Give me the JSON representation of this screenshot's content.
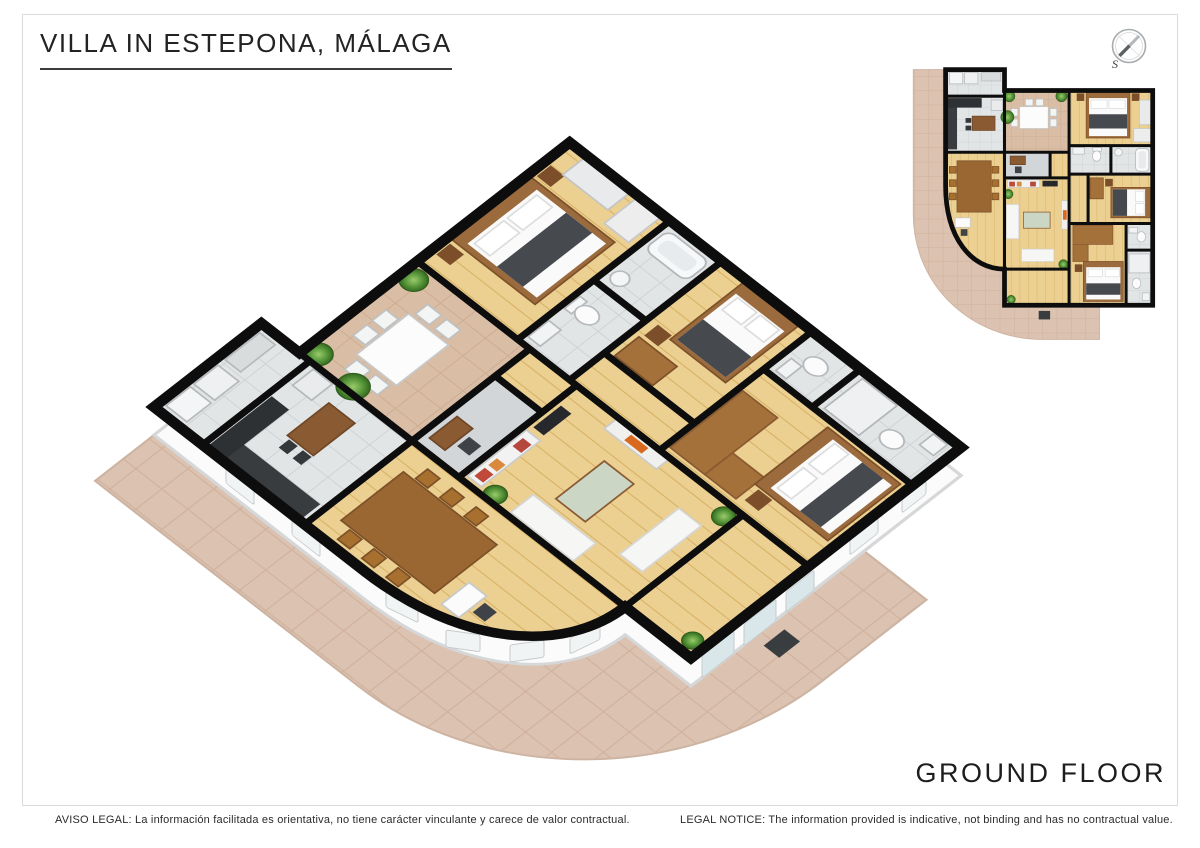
{
  "header": {
    "title": "VILLA IN ESTEPONA, MÁLAGA"
  },
  "floor_label": "GROUND FLOOR",
  "compass": {
    "south_label": "S"
  },
  "footer": {
    "legal_es": "AVISO LEGAL: La información facilitada es orientativa, no tiene carácter vinculante y carece de valor contractual.",
    "legal_en": "LEGAL NOTICE: The information provided is indicative, not binding and has no contractual value."
  },
  "colors": {
    "wall": "#0d0d0d",
    "wood_floor": "#ebd092",
    "wood_line": "#d8b164",
    "tile_floor": "#e2e5e6",
    "patio_floor": "#d9bda5",
    "terrace": "#dcc2b0",
    "hall_floor": "#d3d6d8",
    "wall_face": "#fbfbfb",
    "glass": "#d9e6ea",
    "window": "#f1f4f5",
    "wood_furniture": "#9c6b3d",
    "dark_furniture": "#393c3f",
    "frame_border": "#d9dadb",
    "text": "#232323"
  },
  "plan": {
    "outline": "M48,8 H110 V30 H266 V256 H110 V218 C75,218 48,185 48,130 Z",
    "terrace": "M48,8 V130 C48,185 75,218 110,218 V256 H210 V292 H150 C75,292 14,235 14,160 V8 Z",
    "walls": [
      "M48,36 H110",
      "M48,95 H110",
      "M110,8 V218",
      "M110,95 H178",
      "M110,122 H178",
      "M158,95 V122",
      "M178,30 V256",
      "M178,88 H266",
      "M222,88 V118",
      "M178,118 H266",
      "M198,118 V170",
      "M178,170 H266",
      "M238,170 V256",
      "M238,198 H266",
      "M110,218 H178"
    ],
    "rooms": [
      {
        "name": "utility-room",
        "floor": "tile",
        "rect": [
          48,
          8,
          62,
          28
        ]
      },
      {
        "name": "kitchen",
        "floor": "tile",
        "rect": [
          48,
          36,
          62,
          59
        ]
      },
      {
        "name": "dining-room",
        "floor": "wood",
        "path": "M48,95 H110 V218 C75,218 48,185 48,130 Z"
      },
      {
        "name": "patio-terrace",
        "floor": "tan",
        "rect": [
          110,
          30,
          68,
          65
        ]
      },
      {
        "name": "bedroom-1",
        "floor": "wood",
        "rect": [
          178,
          30,
          88,
          58
        ]
      },
      {
        "name": "entry-hall",
        "floor": "gray",
        "rect": [
          110,
          95,
          48,
          27
        ]
      },
      {
        "name": "corridor-to-patio",
        "floor": "wood",
        "rect": [
          158,
          95,
          20,
          27
        ]
      },
      {
        "name": "living-room",
        "floor": "wood",
        "rect": [
          110,
          122,
          68,
          96
        ]
      },
      {
        "name": "bathroom-1",
        "floor": "tile",
        "rect": [
          178,
          88,
          44,
          30
        ]
      },
      {
        "name": "bathroom-2",
        "floor": "tile",
        "rect": [
          222,
          88,
          44,
          30
        ]
      },
      {
        "name": "corridor",
        "floor": "wood",
        "rect": [
          178,
          118,
          20,
          52
        ]
      },
      {
        "name": "bedroom-2",
        "floor": "wood",
        "rect": [
          198,
          118,
          68,
          52
        ]
      },
      {
        "name": "wc",
        "floor": "tile",
        "rect": [
          238,
          170,
          28,
          28
        ]
      },
      {
        "name": "bedroom-3",
        "floor": "wood",
        "rect": [
          178,
          170,
          60,
          86
        ]
      },
      {
        "name": "bathroom-3",
        "floor": "tile",
        "rect": [
          238,
          198,
          28,
          58
        ]
      },
      {
        "name": "sunroom",
        "floor": "wood",
        "rect": [
          110,
          218,
          68,
          38
        ]
      }
    ],
    "furniture": [
      {
        "k": "r",
        "x": 52,
        "y": 11,
        "w": 14,
        "h": 12,
        "f": "#f4f5f6",
        "s": "#b7babc"
      },
      {
        "k": "r",
        "x": 68,
        "y": 11,
        "w": 14,
        "h": 12,
        "f": "#eef0f1",
        "s": "#b7babc"
      },
      {
        "k": "r",
        "x": 86,
        "y": 11,
        "w": 20,
        "h": 9,
        "f": "#d9dcdd",
        "s": "#b7babc"
      },
      {
        "k": "r",
        "x": 50,
        "y": 40,
        "w": 10,
        "h": 52,
        "f": "#393c3f"
      },
      {
        "k": "r",
        "x": 50,
        "y": 38,
        "w": 36,
        "h": 10,
        "f": "#2e3134"
      },
      {
        "k": "r",
        "x": 96,
        "y": 40,
        "w": 12,
        "h": 11,
        "f": "#e9ebec",
        "s": "#b7babc"
      },
      {
        "k": "r",
        "x": 76,
        "y": 57,
        "w": 24,
        "h": 15,
        "f": "#8a5a33",
        "s": "#6f4726"
      },
      {
        "k": "r",
        "x": 69,
        "y": 59,
        "w": 6,
        "h": 5,
        "f": "#35383b"
      },
      {
        "k": "r",
        "x": 69,
        "y": 67,
        "w": 6,
        "h": 5,
        "f": "#35383b"
      },
      {
        "k": "r",
        "x": 126,
        "y": 47,
        "w": 30,
        "h": 23,
        "f": "#fcfcfc",
        "s": "#c7c9ca"
      },
      {
        "k": "r",
        "x": 117,
        "y": 49,
        "w": 7,
        "h": 8,
        "f": "#f3f4f4",
        "s": "#bfc1c2"
      },
      {
        "k": "r",
        "x": 117,
        "y": 60,
        "w": 7,
        "h": 8,
        "f": "#f3f4f4",
        "s": "#bfc1c2"
      },
      {
        "k": "r",
        "x": 158,
        "y": 49,
        "w": 7,
        "h": 8,
        "f": "#f3f4f4",
        "s": "#bfc1c2"
      },
      {
        "k": "r",
        "x": 158,
        "y": 60,
        "w": 7,
        "h": 8,
        "f": "#f3f4f4",
        "s": "#bfc1c2"
      },
      {
        "k": "r",
        "x": 132,
        "y": 39,
        "w": 8,
        "h": 7,
        "f": "#f3f4f4",
        "s": "#bfc1c2"
      },
      {
        "k": "r",
        "x": 143,
        "y": 39,
        "w": 8,
        "h": 7,
        "f": "#f3f4f4",
        "s": "#bfc1c2"
      },
      {
        "k": "p",
        "cx": 115,
        "cy": 36,
        "r": 6
      },
      {
        "k": "p",
        "cx": 170,
        "cy": 36,
        "r": 6
      },
      {
        "k": "p",
        "cx": 113,
        "cy": 58,
        "r": 7
      },
      {
        "k": "r",
        "x": 186,
        "y": 33,
        "w": 8,
        "h": 8,
        "f": "#7c4f2a"
      },
      {
        "k": "r",
        "x": 244,
        "y": 33,
        "w": 8,
        "h": 8,
        "f": "#7c4f2a"
      },
      {
        "k": "r",
        "x": 196,
        "y": 32,
        "w": 46,
        "h": 48,
        "f": "#9c6b3d",
        "s": "#7d5128"
      },
      {
        "k": "r",
        "x": 199,
        "y": 38,
        "w": 40,
        "h": 40,
        "f": "#fafafa"
      },
      {
        "k": "r",
        "x": 201,
        "y": 40,
        "w": 17,
        "h": 9,
        "f": "#ffffff",
        "s": "#dddddd"
      },
      {
        "k": "r",
        "x": 220,
        "y": 40,
        "w": 17,
        "h": 9,
        "f": "#ffffff",
        "s": "#dddddd"
      },
      {
        "k": "r",
        "x": 199,
        "y": 55,
        "w": 40,
        "h": 15,
        "f": "#46494e"
      },
      {
        "k": "r",
        "x": 252,
        "y": 40,
        "w": 12,
        "h": 26,
        "f": "#e9eaeb",
        "s": "#c2c4c6"
      },
      {
        "k": "r",
        "x": 246,
        "y": 70,
        "w": 18,
        "h": 14,
        "f": "#ededee",
        "s": "#c6c8ca"
      },
      {
        "k": "r",
        "x": 116,
        "y": 99,
        "w": 16,
        "h": 9,
        "f": "#8a5a33",
        "s": "#6f4726"
      },
      {
        "k": "r",
        "x": 121,
        "y": 110,
        "w": 7,
        "h": 7,
        "f": "#3f4347"
      },
      {
        "k": "r",
        "x": 182,
        "y": 90,
        "w": 12,
        "h": 7,
        "f": "#f2f3f4",
        "s": "#b7babc"
      },
      {
        "k": "r",
        "x": 203,
        "y": 90,
        "w": 9,
        "h": 4,
        "f": "#f6f7f8",
        "s": "#b7babc"
      },
      {
        "k": "e",
        "cx": 207,
        "cy": 99,
        "rx": 4.5,
        "ry": 5.5,
        "f": "#fbfbfc",
        "s": "#b7babc"
      },
      {
        "k": "e",
        "cx": 230,
        "cy": 95,
        "rx": 4,
        "ry": 4,
        "f": "#f4f5f6",
        "s": "#b7babc"
      },
      {
        "k": "r",
        "x": 248,
        "y": 91,
        "w": 14,
        "h": 24,
        "rx": 4,
        "f": "#f7f8f9",
        "s": "#b2b6b8"
      },
      {
        "k": "r",
        "x": 251,
        "y": 94,
        "w": 8,
        "h": 18,
        "rx": 3,
        "f": "#e7ebed"
      },
      {
        "k": "r",
        "x": 60,
        "y": 104,
        "w": 36,
        "h": 54,
        "f": "#9a6733",
        "s": "#7d5128"
      },
      {
        "k": "r",
        "x": 52,
        "y": 110,
        "w": 7,
        "h": 7,
        "f": "#a8702f",
        "s": "#7d5128"
      },
      {
        "k": "r",
        "x": 52,
        "y": 124,
        "w": 7,
        "h": 7,
        "f": "#a8702f",
        "s": "#7d5128"
      },
      {
        "k": "r",
        "x": 52,
        "y": 138,
        "w": 7,
        "h": 7,
        "f": "#a8702f",
        "s": "#7d5128"
      },
      {
        "k": "r",
        "x": 97,
        "y": 110,
        "w": 7,
        "h": 7,
        "f": "#a8702f",
        "s": "#7d5128"
      },
      {
        "k": "r",
        "x": 97,
        "y": 124,
        "w": 7,
        "h": 7,
        "f": "#a8702f",
        "s": "#7d5128"
      },
      {
        "k": "r",
        "x": 97,
        "y": 138,
        "w": 7,
        "h": 7,
        "f": "#a8702f",
        "s": "#7d5128"
      },
      {
        "k": "r",
        "x": 58,
        "y": 164,
        "w": 16,
        "h": 10,
        "f": "#fbfbfc",
        "s": "#c7c9ca"
      },
      {
        "k": "r",
        "x": 64,
        "y": 176,
        "w": 7,
        "h": 7,
        "f": "#3f4347"
      },
      {
        "k": "r",
        "x": 113,
        "y": 124,
        "w": 34,
        "h": 8,
        "f": "#f2f2f3",
        "s": "#c9cbcc"
      },
      {
        "k": "r",
        "x": 115,
        "y": 126,
        "w": 6,
        "h": 5,
        "f": "#c04a3a"
      },
      {
        "k": "r",
        "x": 123,
        "y": 126,
        "w": 5,
        "h": 5,
        "f": "#d98a3d"
      },
      {
        "k": "r",
        "x": 137,
        "y": 126,
        "w": 6,
        "h": 5,
        "f": "#b5483b"
      },
      {
        "k": "r",
        "x": 150,
        "y": 125,
        "w": 16,
        "h": 6,
        "f": "#26282b"
      },
      {
        "k": "r",
        "x": 112,
        "y": 150,
        "w": 13,
        "h": 36,
        "f": "#f6f6f5",
        "s": "#d6d6d4"
      },
      {
        "k": "r",
        "x": 128,
        "y": 197,
        "w": 34,
        "h": 13,
        "f": "#f6f6f5",
        "s": "#d6d6d4"
      },
      {
        "k": "r",
        "x": 130,
        "y": 158,
        "w": 28,
        "h": 17,
        "f": "#ccd6c5",
        "s": "#8a5a33"
      },
      {
        "k": "r",
        "x": 170,
        "y": 146,
        "w": 7,
        "h": 30,
        "f": "#f0f0ef",
        "s": "#cccccc"
      },
      {
        "k": "r",
        "x": 171.5,
        "y": 156,
        "w": 4,
        "h": 10,
        "f": "#d8691f"
      },
      {
        "k": "p",
        "cx": 114,
        "cy": 139,
        "r": 5
      },
      {
        "k": "p",
        "cx": 172,
        "cy": 213,
        "r": 5
      },
      {
        "k": "r",
        "x": 200,
        "y": 122,
        "w": 14,
        "h": 22,
        "f": "#a4713b",
        "s": "#7d5128"
      },
      {
        "k": "r",
        "x": 216,
        "y": 123,
        "w": 8,
        "h": 8,
        "f": "#7c4f2a"
      },
      {
        "k": "r",
        "x": 222,
        "y": 132,
        "w": 42,
        "h": 32,
        "f": "#9c6b3d",
        "s": "#7d5128"
      },
      {
        "k": "r",
        "x": 224,
        "y": 134,
        "w": 34,
        "h": 28,
        "f": "#fafafa"
      },
      {
        "k": "r",
        "x": 248,
        "y": 136,
        "w": 9,
        "h": 11,
        "f": "#ffffff",
        "s": "#dddddd"
      },
      {
        "k": "r",
        "x": 248,
        "y": 149,
        "w": 9,
        "h": 11,
        "f": "#ffffff",
        "s": "#dddddd"
      },
      {
        "k": "r",
        "x": 224,
        "y": 134,
        "w": 15,
        "h": 28,
        "f": "#46494e"
      },
      {
        "k": "r",
        "x": 241,
        "y": 174,
        "w": 9,
        "h": 6,
        "f": "#f2f3f4",
        "s": "#b7babc"
      },
      {
        "k": "e",
        "cx": 254,
        "cy": 184,
        "rx": 4.5,
        "ry": 5.5,
        "f": "#fbfbfc",
        "s": "#b7babc"
      },
      {
        "k": "r",
        "x": 182,
        "y": 172,
        "w": 42,
        "h": 20,
        "f": "#a4713b",
        "s": "#8a5a30"
      },
      {
        "k": "r",
        "x": 182,
        "y": 192,
        "w": 16,
        "h": 18,
        "f": "#a4713b",
        "s": "#8a5a30"
      },
      {
        "k": "r",
        "x": 184,
        "y": 213,
        "w": 8,
        "h": 8,
        "f": "#7c4f2a"
      },
      {
        "k": "r",
        "x": 193,
        "y": 210,
        "w": 42,
        "h": 42,
        "f": "#9c6b3d",
        "s": "#7d5128"
      },
      {
        "k": "r",
        "x": 196,
        "y": 216,
        "w": 36,
        "h": 34,
        "f": "#fafafa"
      },
      {
        "k": "r",
        "x": 198,
        "y": 218,
        "w": 15,
        "h": 8,
        "f": "#ffffff",
        "s": "#dddddd"
      },
      {
        "k": "r",
        "x": 216,
        "y": 218,
        "w": 15,
        "h": 8,
        "f": "#ffffff",
        "s": "#dddddd"
      },
      {
        "k": "r",
        "x": 196,
        "y": 233,
        "w": 36,
        "h": 12,
        "f": "#46494e"
      },
      {
        "k": "r",
        "x": 241,
        "y": 202,
        "w": 22,
        "h": 20,
        "f": "#eef0f1",
        "s": "#b2b6b8"
      },
      {
        "k": "e",
        "cx": 249,
        "cy": 233,
        "rx": 4.5,
        "ry": 5.5,
        "f": "#fbfbfc",
        "s": "#b7babc"
      },
      {
        "k": "r",
        "x": 255,
        "y": 243,
        "w": 8,
        "h": 8,
        "f": "#f2f3f4",
        "s": "#b7babc"
      },
      {
        "k": "p",
        "cx": 117,
        "cy": 250,
        "r": 4.5
      }
    ],
    "terrace_furniture": [
      {
        "k": "r",
        "x": 146,
        "y": 262,
        "w": 12,
        "h": 9,
        "f": "#3a3d40"
      },
      {
        "k": "p",
        "cx": 122,
        "cy": 226,
        "r": 4
      }
    ],
    "skirt_windows": [
      {
        "x": 386,
        "y": 590,
        "w": 32,
        "h": 17,
        "sk": 26
      },
      {
        "x": 446,
        "y": 630,
        "w": 34,
        "h": 17,
        "sk": 8
      },
      {
        "x": 510,
        "y": 645,
        "w": 34,
        "h": 17,
        "sk": -8
      },
      {
        "x": 570,
        "y": 638,
        "w": 30,
        "h": 16,
        "sk": -26
      },
      {
        "x": 226,
        "y": 468,
        "w": 28,
        "h": 15,
        "sk": 38
      },
      {
        "x": 292,
        "y": 520,
        "w": 28,
        "h": 15,
        "sk": 38
      },
      {
        "x": 700,
        "y": 248,
        "w": 30,
        "h": 15,
        "sk": 38
      },
      {
        "x": 788,
        "y": 318,
        "w": 30,
        "h": 15,
        "sk": 38
      },
      {
        "x": 868,
        "y": 380,
        "w": 24,
        "h": 13,
        "sk": 38
      },
      {
        "x": 702,
        "y": 656,
        "w": 32,
        "h": 22,
        "sk": -38,
        "glass": true
      },
      {
        "x": 744,
        "y": 624,
        "w": 32,
        "h": 22,
        "sk": -38,
        "glass": true
      },
      {
        "x": 786,
        "y": 592,
        "w": 28,
        "h": 20,
        "sk": -38,
        "glass": true
      },
      {
        "x": 850,
        "y": 540,
        "w": 28,
        "h": 15,
        "sk": -38
      },
      {
        "x": 902,
        "y": 500,
        "w": 24,
        "h": 13,
        "sk": -38
      }
    ]
  }
}
